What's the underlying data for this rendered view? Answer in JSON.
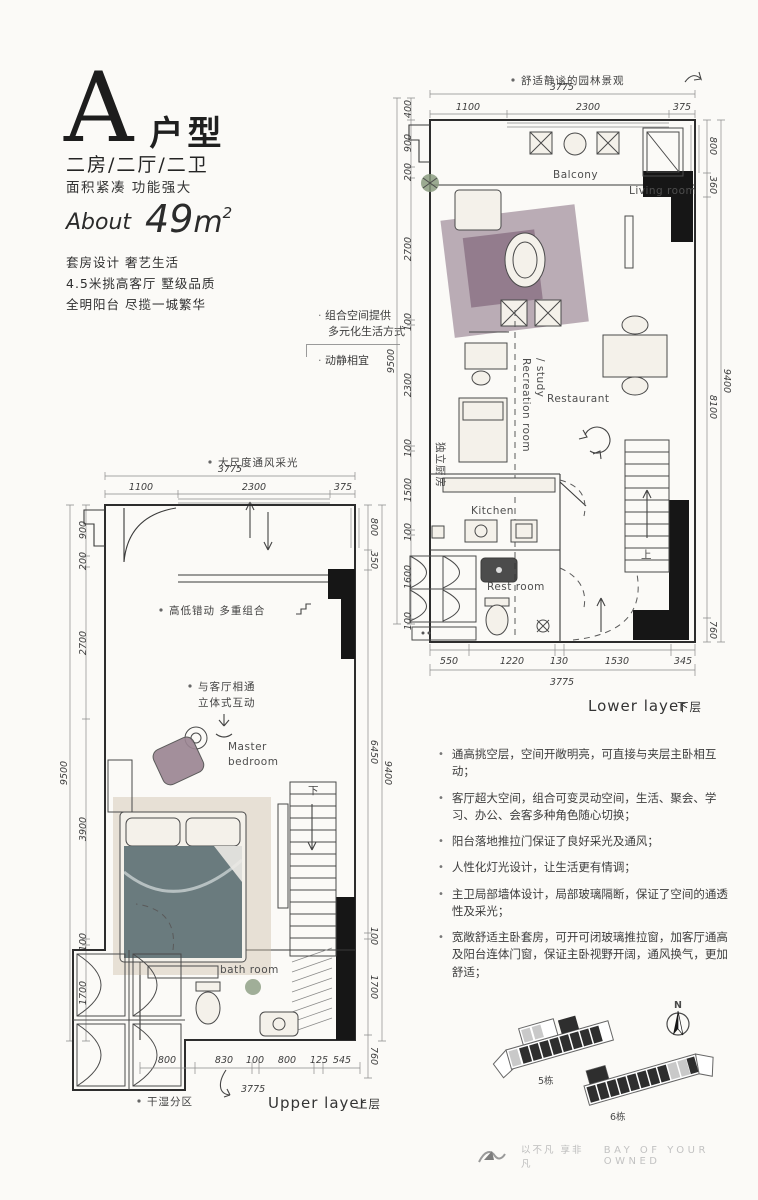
{
  "header": {
    "type_letter": "A",
    "type_suffix": "户型",
    "layout_line": "二房/二厅/二卫",
    "tagline": "面积紧凑 功能强大",
    "about_label": "About",
    "area_value": "49",
    "area_unit": "m",
    "area_sup": "2",
    "features": [
      "套房设计 奢艺生活",
      "4.5米挑高客厅 墅级品质",
      "全明阳台 尽揽一城繁华"
    ]
  },
  "lower": {
    "annotation_top": "舒适静谧的园林景观",
    "total_top": "3775",
    "dims_top": [
      "1100",
      "2300",
      "375"
    ],
    "dims_left": [
      "400",
      "900",
      "200",
      "2700",
      "100",
      "2300",
      "100",
      "1500",
      "100",
      "1600",
      "100"
    ],
    "total_left": "9500",
    "dims_right": [
      "800",
      "360",
      "8100",
      "760"
    ],
    "total_right": "9400",
    "dims_bottom": [
      "550",
      "1220",
      "130",
      "1530",
      "345"
    ],
    "total_bottom": "3775",
    "rooms": {
      "balcony": "Balcony",
      "living": "Living room",
      "recreation_1": "Recreation room",
      "recreation_2": "/ study",
      "restaurant": "Restaurant",
      "kitchen": "Kitchen",
      "rest": "Rest room"
    },
    "stairs_up": "上",
    "note_combo_1": "组合空间提供",
    "note_combo_2": "多元化生活方式",
    "note_quiet": "动静相宜",
    "note_kitchen": "独立厨房",
    "label_en": "Lower layer",
    "label_cn": "下层"
  },
  "upper": {
    "annotation_top": "大尺度通风采光",
    "total_top": "3775",
    "dims_top": [
      "1100",
      "2300",
      "375"
    ],
    "dims_left": [
      "900",
      "200",
      "2700",
      "3900",
      "100",
      "1700"
    ],
    "total_left": "9500",
    "dims_right": [
      "800",
      "350",
      "6450",
      "100",
      "1700",
      "760"
    ],
    "total_right": "9400",
    "dims_bottom": [
      "800",
      "830",
      "100",
      "800",
      "125",
      "545"
    ],
    "total_bottom": "3775",
    "rooms": {
      "master_1": "Master",
      "master_2": "bedroom",
      "bath": "bath room"
    },
    "stairs_down": "下",
    "note_combo": "高低错动 多重组合",
    "note_connect_1": "与客厅相通",
    "note_connect_2": "立体式互动",
    "note_drywet": "干湿分区",
    "label_en": "Upper layer",
    "label_cn": "上层"
  },
  "bullets": [
    "通高挑空层，空间开敞明亮，可直接与夹层主卧相互动；",
    "客厅超大空间，组合可变灵动空间，生活、聚会、学习、办公、会客多种角色随心切换；",
    "阳台落地推拉门保证了良好采光及通风；",
    "人性化灯光设计，让生活更有情调；",
    "主卫局部墙体设计，局部玻璃隔断，保证了空间的通透性及采光；",
    "宽敞舒适主卧套房，可开可闭玻璃推拉窗，加客厅通高及阳台连体门窗，保证主卧视野开阔，通风换气，更加舒适；"
  ],
  "site": {
    "building5": "5栋",
    "building6": "6栋",
    "north": "N"
  },
  "footer": {
    "slogan_cn": "以不凡 享非凡",
    "slogan_en": "BAY OF YOUR OWNED"
  },
  "colors": {
    "wall": "#161616",
    "mauve": "#a18e9b",
    "tan": "#b2937f",
    "teal": "#5d7174",
    "sand": "#cabca8"
  }
}
